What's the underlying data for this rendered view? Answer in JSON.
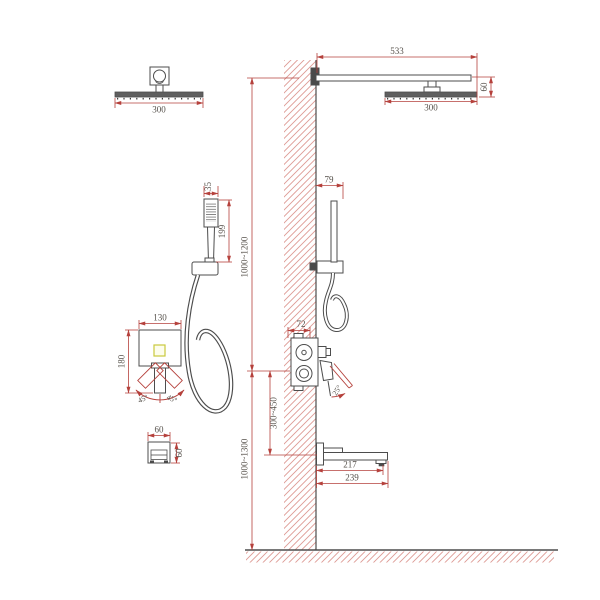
{
  "drawing": {
    "type": "technical-installation-diagram",
    "subject": "wall-mounted shower system with rain head, hand shower, concealed mixer and tub spout",
    "colors": {
      "background": "#ffffff",
      "dimension_red": "#b5413c",
      "hatch_red": "#dd9a94",
      "fixture_outline": "#4d4d4d",
      "text": "#55504a",
      "diverter_yellow": "#c9c93d"
    },
    "views": {
      "rain_head_front": {
        "width": "300"
      },
      "rain_head_side": {
        "arm_length": "533",
        "head_width": "300",
        "head_drop": "60"
      },
      "hand_shower_front": {
        "head_width": "35",
        "length": "199"
      },
      "hand_shower_side": {
        "wall_offset": "79"
      },
      "mixer_front": {
        "plate_width": "130",
        "plate_height": "180",
        "swing_left": "45°",
        "swing_right": "45°"
      },
      "mixer_side": {
        "recess_depth": "72",
        "lever_angle": "25°"
      },
      "tub_spout_side": {
        "reach": "217",
        "total_length": "239"
      },
      "wall_outlet_front": {
        "width": "60",
        "height": "60"
      },
      "install_heights": {
        "arm_above_mixer": "1000~1200",
        "mixer_above_spout": "300~450",
        "mixer_above_floor": "1000~1300"
      }
    }
  }
}
